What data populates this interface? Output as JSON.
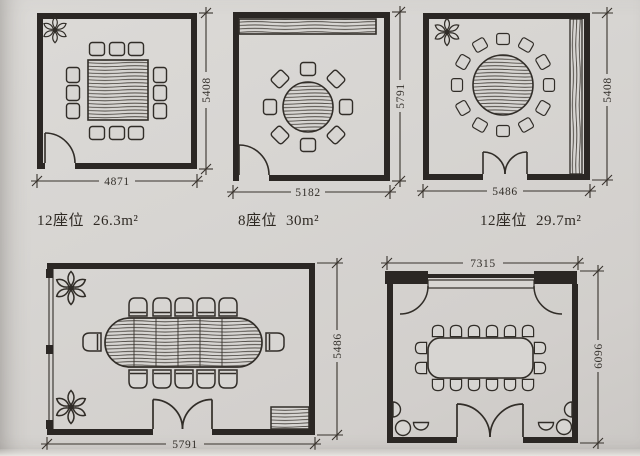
{
  "page": {
    "type": "scanned architectural floor-plan sheet of dining/meeting rooms",
    "colors": {
      "paper": "#d7d5d2",
      "ink": "#312d28",
      "wall": "#2b2724"
    }
  },
  "plans": [
    {
      "name": "square room, rectangular 12-seat table",
      "caption_seats": "12座位",
      "caption_area": "26.3m²",
      "dim_width": "4871",
      "dim_height": "5408"
    },
    {
      "name": "square room, round 8-seat table with sideboard",
      "caption_seats": "8座位",
      "caption_area": "30m²",
      "dim_width": "5182",
      "dim_height": "5791"
    },
    {
      "name": "square room, round 12-seat table, double door",
      "caption_seats": "12座位",
      "caption_area": "29.7m²",
      "dim_width": "5486",
      "dim_height": "5408"
    },
    {
      "name": "wide room, oval conference table, window wall, plants",
      "dim_width": "5791",
      "dim_height": "5486"
    },
    {
      "name": "banquet room with movable partition and lounge corners",
      "dim_width": "7315",
      "dim_height": "6096"
    }
  ]
}
